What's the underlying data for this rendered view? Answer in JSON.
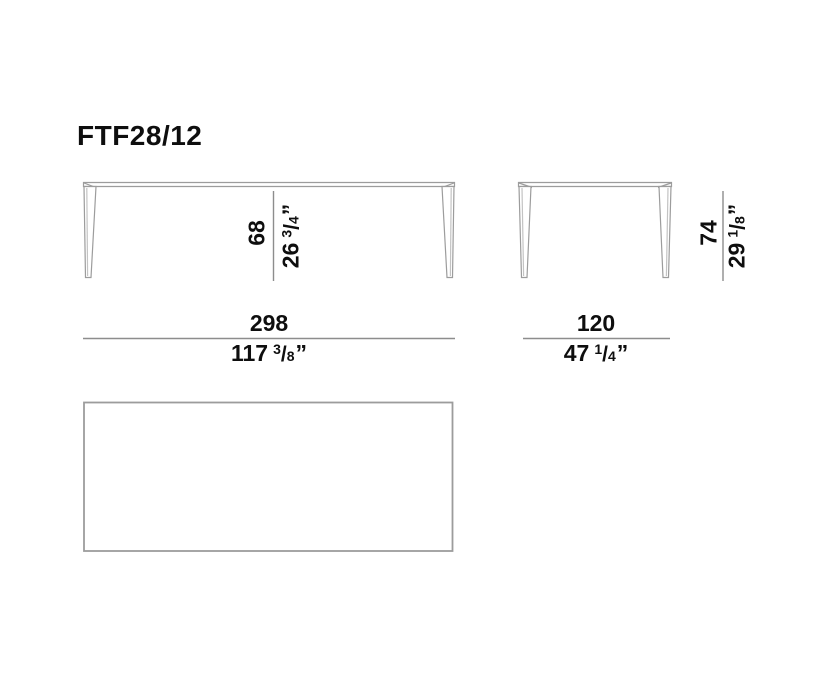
{
  "title": "FTF28/12",
  "colors": {
    "drawing_line": "#9c9c9c",
    "drawing_line_light": "#c3c3c3",
    "dimension_line": "#8d8d8d",
    "text": "#0e0e0e",
    "background": "#ffffff"
  },
  "front_view": {
    "height": {
      "cm": "68",
      "inch_whole": "26",
      "inch_num": "3",
      "inch_slash": "/",
      "inch_den": "4",
      "inch_mark": "”"
    },
    "width": {
      "cm": "298",
      "inch_whole": "117",
      "inch_num": "3",
      "inch_slash": "/",
      "inch_den": "8",
      "inch_mark": "”"
    }
  },
  "side_view": {
    "height": {
      "cm": "74",
      "inch_whole": "29",
      "inch_num": "1",
      "inch_slash": "/",
      "inch_den": "8",
      "inch_mark": "”"
    },
    "depth": {
      "cm": "120",
      "inch_whole": "47",
      "inch_num": "1",
      "inch_slash": "/",
      "inch_den": "4",
      "inch_mark": "”"
    }
  }
}
